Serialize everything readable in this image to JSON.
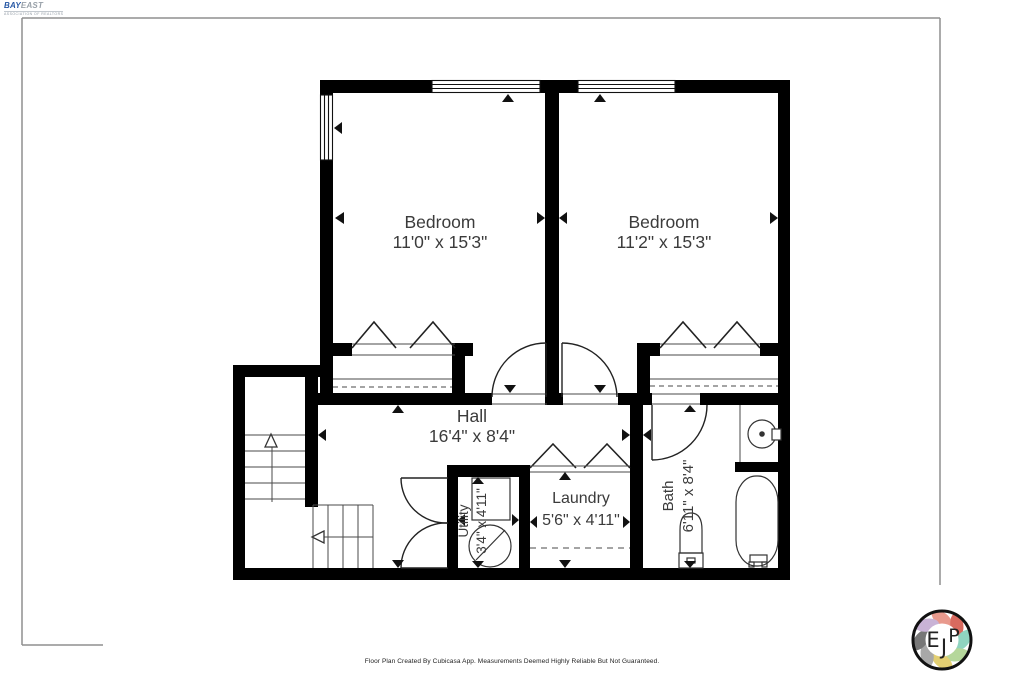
{
  "header_logo": {
    "primary": "BAY",
    "secondary": "EAST",
    "tagline": "ASSOCIATION OF REALTORS"
  },
  "rooms": {
    "bedroom_left": {
      "name": "Bedroom",
      "dims": "11'0\" x 15'3\""
    },
    "bedroom_right": {
      "name": "Bedroom",
      "dims": "11'2\" x 15'3\""
    },
    "hall": {
      "name": "Hall",
      "dims": "16'4\" x 8'4\""
    },
    "laundry": {
      "name": "Laundry",
      "dims": "5'6\" x 4'11\""
    },
    "utility": {
      "name": "Utility",
      "dims": "3'4\" x 4'11\""
    },
    "bath": {
      "name": "Bath",
      "dims": "6'11\" x 8'4\""
    }
  },
  "footer": {
    "disclaimer": "Floor Plan Created By Cubicasa App. Measurements Deemed Highly Reliable But Not Guaranteed."
  },
  "badge": {
    "letter_e": "E",
    "letter_j": "J",
    "letter_p": "P"
  },
  "colors": {
    "wall": "#000000",
    "frame_gray": "#8f8f8f",
    "logo_blue": "#2456a4",
    "badge_petals": [
      "#e8998d",
      "#d96a5f",
      "#8fd4c0",
      "#b5d79b",
      "#e3cf72",
      "#a8a8a8",
      "#777777",
      "#c9b3d6"
    ]
  }
}
